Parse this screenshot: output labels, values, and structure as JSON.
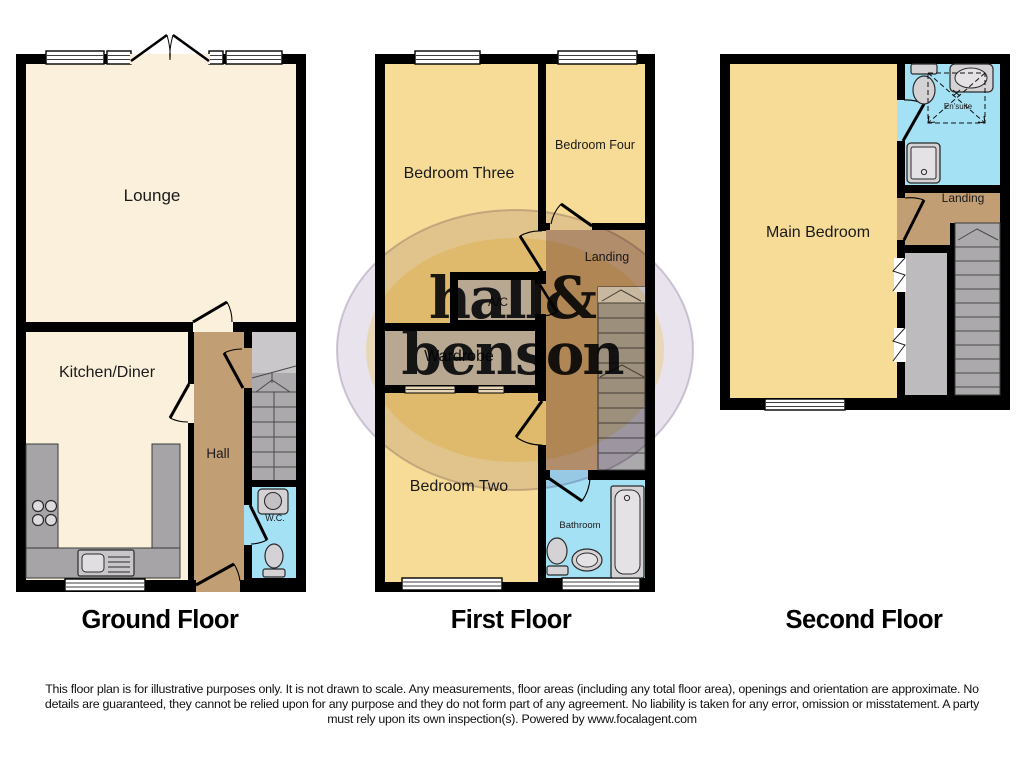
{
  "colors": {
    "wall": "#000000",
    "room_cream": "#FAF0DB",
    "room_yellow": "#F6DC96",
    "hall_tan": "#C29E74",
    "bathroom_blue": "#A5E1F5",
    "closet_gray": "#CAC7CA",
    "stairs_gray": "#ACA9AC",
    "eaves_gray": "#BEBBBE",
    "counter_gray": "#A7A4A7",
    "fixture_fill": "#D5D2D5",
    "watermark_gold": "#E9CD7D",
    "watermark_purple": "#D4C8DD",
    "text": "#1A1A1A"
  },
  "watermark": {
    "line1": "hall&",
    "line2": "benson"
  },
  "floors": {
    "ground": {
      "title": "Ground Floor",
      "rooms": {
        "lounge": "Lounge",
        "kitchen": "Kitchen/Diner",
        "hall": "Hall",
        "wc": "W.C."
      }
    },
    "first": {
      "title": "First Floor",
      "rooms": {
        "bedroom_three": "Bedroom Three",
        "bedroom_four": "Bedroom Four",
        "landing": "Landing",
        "ac": "A/C",
        "wardrobe": "Wardrobe",
        "bedroom_two": "Bedroom Two",
        "bathroom": "Bathroom"
      }
    },
    "second": {
      "title": "Second Floor",
      "rooms": {
        "main_bedroom": "Main Bedroom",
        "ensuite": "En'suite",
        "landing": "Landing"
      }
    }
  },
  "icons": [
    "toilet-icon",
    "basin-icon",
    "sink-icon",
    "hob-icon",
    "bath-icon",
    "shower-icon",
    "stairs-icon",
    "window-icon",
    "door-arc-icon",
    "eaves-hatch-icon",
    "head-height-dashed-icon"
  ],
  "disclaimer": {
    "line1": "This floor plan is for illustrative purposes only. It is not drawn to scale. Any measurements, floor areas (including any total floor area), openings and orientation are approximate. No",
    "line2": "details are guaranteed, they cannot be relied upon for any purpose and they do not form part of any agreement. No liability is taken for any error, omission or misstatement. A party",
    "line3": "must rely upon its own inspection(s). Powered by www.focalagent.com"
  }
}
